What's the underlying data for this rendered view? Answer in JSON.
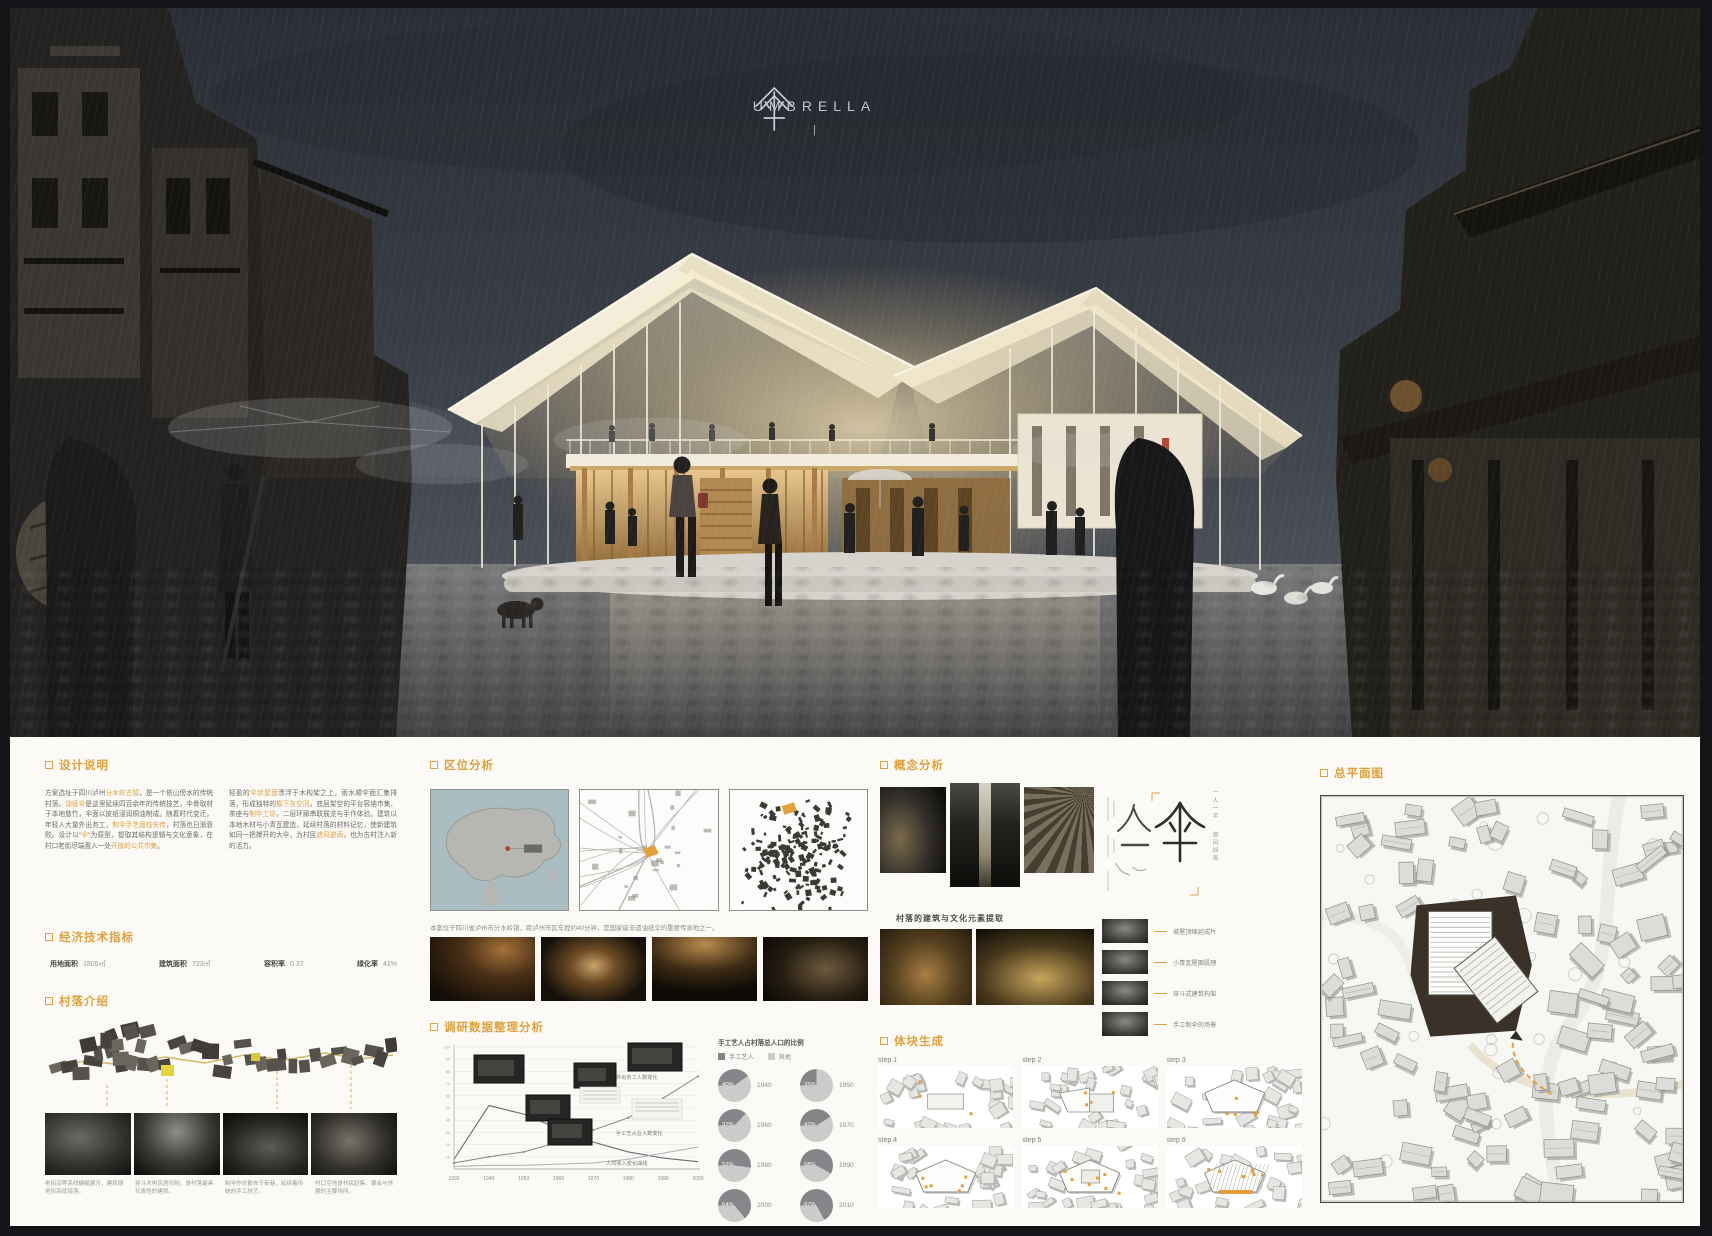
{
  "hero": {
    "logo_char": "傘",
    "logo_title": "UMBRELLA",
    "logo_mark": "|"
  },
  "design": {
    "title": "设计说明",
    "col1": [
      {
        "t": "方案选址于四川泸州"
      },
      {
        "t": "分水岭古镇",
        "hl": true
      },
      {
        "t": "，是一个依山傍水的传统村落。"
      },
      {
        "t": "油纸伞",
        "hl": true
      },
      {
        "t": "是这里延续四百余年的传统技艺，伞骨取材于本地慈竹，伞面以皮纸浸润桐油制成。随着时代变迁，年轻人大量外出务工，"
      },
      {
        "t": "制伞手艺面临失传",
        "hl": true
      },
      {
        "t": "，村落也日渐衰败。设计以“"
      },
      {
        "t": "伞",
        "hl": true
      },
      {
        "t": "”为原型，提取其结构逻辑与文化意象，在村口老街尽端置入一处"
      },
      {
        "t": "开放的公共市集",
        "hl": true
      },
      {
        "t": "。"
      }
    ],
    "col2": [
      {
        "t": "轻盈的"
      },
      {
        "t": "伞状屋面",
        "hl": true
      },
      {
        "t": "漂浮于木构架之上，雨水顺伞面汇集排落，形成独特的"
      },
      {
        "t": "檐下灰空间",
        "hl": true
      },
      {
        "t": "。底层架空的平台容纳市集、茶座与"
      },
      {
        "t": "制伞工坊",
        "hl": true
      },
      {
        "t": "，二层环廊串联展览与手作体验。建筑以本地木材与小青瓦建造，延续村落的材料记忆，使新建筑如同一把撑开的大伞，为村民"
      },
      {
        "t": "遮风避雨",
        "hl": true
      },
      {
        "t": "，也为古村注入新的活力。"
      }
    ]
  },
  "indicators": {
    "title": "经济技术指标",
    "items": [
      {
        "label": "用地面积",
        "value": "1805㎡"
      },
      {
        "label": "建筑面积",
        "value": "723㎡"
      },
      {
        "label": "容积率",
        "value": "0.37"
      },
      {
        "label": "绿化率",
        "value": "41%"
      }
    ]
  },
  "village": {
    "title": "村落介绍",
    "captions": [
      "老街沿等高线蜿蜒展开，建筑随地形高低错落。",
      "穿斗木构民居形制，是村落最具代表性的建筑。",
      "制伞作坊散布于街巷，延续着传统的手工技艺。",
      "村口空地是村民赶集、聚会与休憩的主要场所。"
    ]
  },
  "location": {
    "title": "区位分析",
    "caption": "本案位于四川省泸州市分水岭镇，距泸州市区车程约40分钟，是国家级非遗油纸伞的重要传承地之一。"
  },
  "survey": {
    "title": "调研数据整理分析"
  },
  "concept": {
    "title": "概念分析",
    "collage_caption": "村落的建筑与文化元素提取",
    "photo_labels": [
      "油纸伞",
      "悬挑吊脚",
      "制伞工艺",
      "老街巷道",
      "市集灯火"
    ],
    "calligraphy": {
      "chars": [
        "人",
        "一",
        "伞"
      ],
      "note": "一人一伞 · 遮风挡雨"
    },
    "right_items": [
      "坡屋顶绵延成片",
      "小青瓦屋面肌理",
      "穿斗式建筑构架",
      "手工制伞的场景"
    ]
  },
  "massing": {
    "title": "体块生成",
    "steps": [
      "step 1",
      "step 2",
      "step 3",
      "step 4",
      "step 5",
      "step 6"
    ]
  },
  "siteplan": {
    "title": "总平面图"
  },
  "chart_data": [
    {
      "type": "line",
      "title": "村落人口与手工艺变迁",
      "x": [
        1930,
        1940,
        1950,
        1960,
        1970,
        1980,
        1990,
        2000
      ],
      "series": [
        {
          "name": "外出务工人数变化",
          "values": [
            5,
            10,
            14,
            22,
            32,
            42,
            58,
            76
          ]
        },
        {
          "name": "手工艺从业人数变化",
          "values": [
            8,
            52,
            45,
            33,
            22,
            14,
            9,
            6
          ]
        },
        {
          "name": "人均收入变化曲线",
          "values": [
            2,
            3,
            3,
            4,
            5,
            8,
            13,
            18
          ]
        }
      ],
      "ylim": [
        0,
        100
      ],
      "grid": true,
      "legend_position": "right"
    },
    {
      "type": "pie",
      "title": "手工艺人占村落总人口的比例",
      "legend": [
        "手工艺人",
        "其他"
      ],
      "items": [
        {
          "year": "1940",
          "label": "40%",
          "value": 40
        },
        {
          "year": "1950",
          "label": "25%",
          "value": 25
        },
        {
          "year": "1960",
          "label": "37%",
          "value": 37
        },
        {
          "year": "1970",
          "label": "41%",
          "value": 41
        },
        {
          "year": "1980",
          "label": "52%",
          "value": 52
        },
        {
          "year": "1990",
          "label": "58%",
          "value": 58
        },
        {
          "year": "2000",
          "label": "64%",
          "value": 64
        },
        {
          "year": "2010",
          "label": "67%",
          "value": 67
        }
      ]
    }
  ]
}
